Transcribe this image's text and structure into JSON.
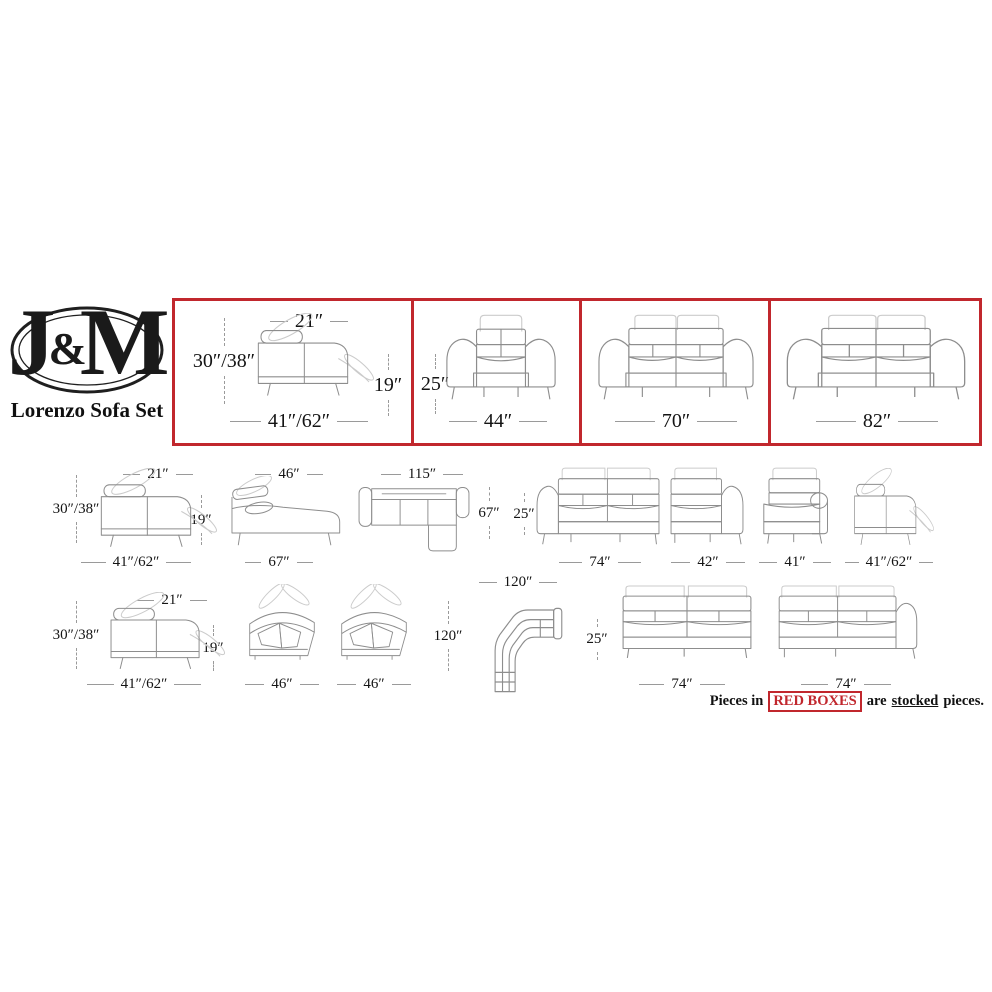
{
  "logo": {
    "letter_j": "J",
    "ampersand": "&",
    "letter_m": "M",
    "title": "Lorenzo Sofa Set"
  },
  "colors": {
    "accent_red": "#c1272d",
    "line_gray": "#8d8d8d",
    "ghost_gray": "#cbcbcb",
    "text": "#141414"
  },
  "stocked_row": {
    "cells": [
      {
        "piece": "recliner-side-view",
        "top": "21″",
        "left": "30″/38″",
        "right": "19″",
        "bottom": "41″/62″"
      },
      {
        "piece": "armchair-front-view",
        "left": "25″",
        "bottom": "44″"
      },
      {
        "piece": "loveseat-front-view",
        "bottom": "70″"
      },
      {
        "piece": "sofa-front-view",
        "bottom": "82″"
      }
    ]
  },
  "row2": [
    {
      "piece": "recliner-side-view",
      "top": "21″",
      "left": "30″/38″",
      "right": "19″",
      "bottom": "41″/62″"
    },
    {
      "piece": "chaise-side-view",
      "top": "46″",
      "bottom": "67″"
    },
    {
      "piece": "sectional-top-view",
      "top": "115″",
      "right": "67″"
    },
    {
      "piece": "left-arm-sofa",
      "left": "25″",
      "bottom": "74″"
    },
    {
      "piece": "right-arm-chair",
      "bottom": "42″"
    },
    {
      "piece": "chaise-front-view",
      "bottom": "41″"
    },
    {
      "piece": "recliner-side-view",
      "bottom": "41″/62″"
    }
  ],
  "row3": [
    {
      "piece": "recliner-side-view",
      "top": "21″",
      "left": "30″/38″",
      "right": "19″",
      "bottom": "41″/62″"
    },
    {
      "piece": "corner-wedge",
      "bottom": "46″"
    },
    {
      "piece": "corner-wedge",
      "bottom": "46″"
    },
    {
      "piece": "corner-sectional-top-view",
      "top": "120″",
      "left": "120″"
    },
    {
      "piece": "armless-sofa",
      "left": "25″",
      "bottom": "74″"
    },
    {
      "piece": "right-arm-sofa",
      "bottom": "74″"
    }
  ],
  "footer": {
    "prefix": "Pieces in",
    "highlight": "RED BOXES",
    "middle": "are",
    "underlined": "stocked",
    "suffix": "pieces."
  }
}
